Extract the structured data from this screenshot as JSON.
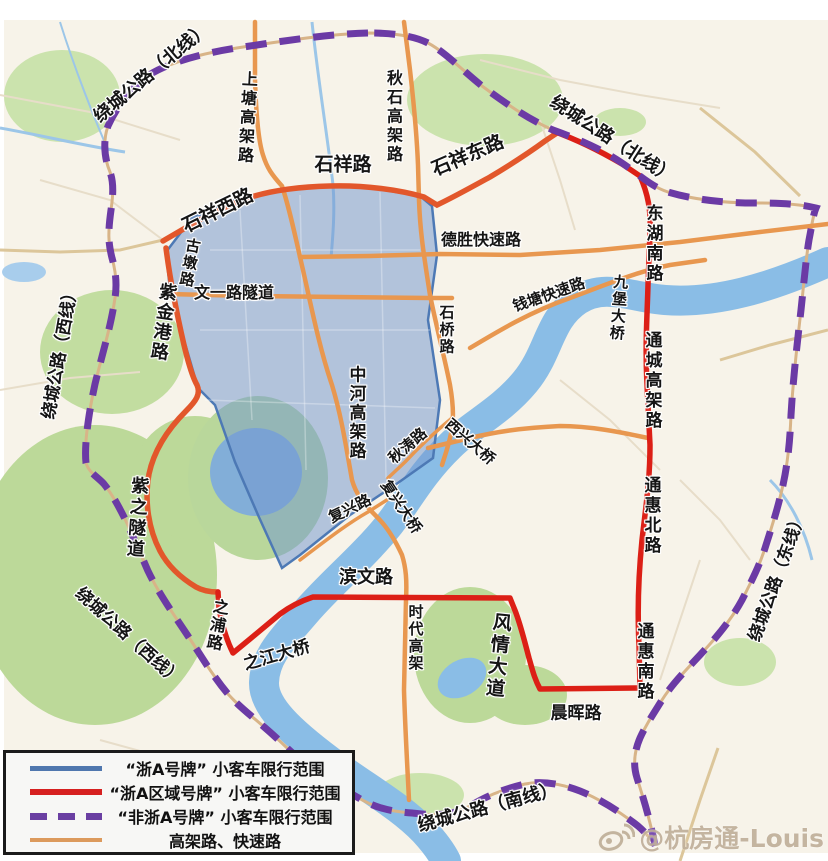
{
  "map": {
    "description": "Hangzhou small passenger car restriction zones map",
    "labels": {
      "ring_north_1": "绕城公路（北线）",
      "ring_north_2": "绕城公路（北线）",
      "ring_west_1": "绕城公路（西线）",
      "ring_west_2": "绕城公路（西线）",
      "ring_east": "绕城公路（东线）",
      "ring_south": "绕城公路（南线）",
      "shangtang": "上塘高架路",
      "qiushi": "秋石高架路",
      "shixiang_w": "石祥西路",
      "shixiang": "石祥路",
      "shixiang_e": "石祥东路",
      "donghu": "东湖南路",
      "desheng": "德胜快速路",
      "gudun": "古墩路",
      "wenyi": "文一路隧道",
      "zijingang": "紫金港路",
      "shiqiao": "石桥路",
      "qiantang": "钱塘快速路",
      "jiubao": "九堡大桥",
      "tongcheng": "通城高架路",
      "zhonghe": "中河高架路",
      "zizhi": "紫之隧道",
      "tonghui_n": "通惠北路",
      "qiutao": "秋涛路",
      "fuxing_rd": "复兴路",
      "fuxing_br": "复兴大桥",
      "xixing": "西兴大桥",
      "zhipu": "之浦路",
      "zhijiang": "之江大桥",
      "binwen": "滨文路",
      "shidai": "时代高架",
      "fengqing": "风情大道",
      "tonghui_s": "通惠南路",
      "chenhui": "晨晖路"
    },
    "colors": {
      "blue_zone_border": "#4d79b5",
      "blue_zone_fill": "rgba(115,152,208,0.52)",
      "red_line": "#dc1f16",
      "purple_dashed": "#6b3aa5",
      "orange_road": "#e8974f",
      "vermilion_road": "#e2572b",
      "river": "#8abde6",
      "green_area": "#cbe3ad",
      "map_bg": "#f7f3e9"
    }
  },
  "legend": {
    "items": [
      {
        "label": "“浙A号牌” 小客车限行范围",
        "color": "#5077ae",
        "style": "solid"
      },
      {
        "label": "“浙A区域号牌” 小客车限行范围",
        "color": "#d6201f",
        "style": "solid"
      },
      {
        "label": "“非浙A号牌” 小客车限行范围",
        "color": "#6a3fa2",
        "style": "dashed"
      },
      {
        "label": "高架路、快速路",
        "color": "#dc9a5c",
        "style": "solid"
      }
    ]
  },
  "watermark": {
    "icon": "weibo-icon",
    "text": "@杭房通-Louis"
  }
}
